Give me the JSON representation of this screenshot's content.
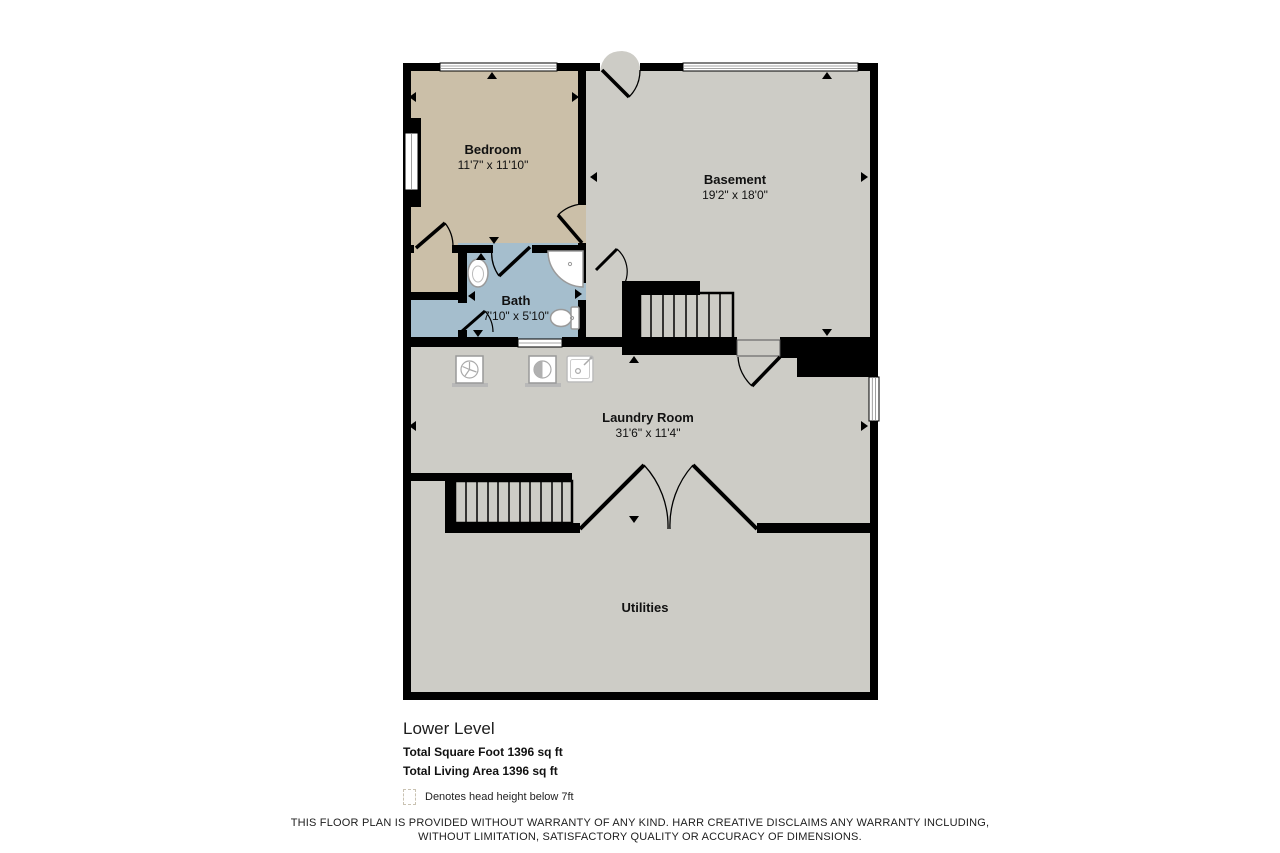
{
  "plan": {
    "rooms": {
      "bedroom": {
        "name": "Bedroom",
        "dims": "11'7\" x 11'10\""
      },
      "basement": {
        "name": "Basement",
        "dims": "19'2\" x 18'0\""
      },
      "bath": {
        "name": "Bath",
        "dims": "7'10\" x 5'10\""
      },
      "laundry": {
        "name": "Laundry Room",
        "dims": "31'6\" x 11'4\""
      },
      "utilities": {
        "name": "Utilities"
      }
    },
    "colors": {
      "bedroom_fill": "#cbbfa8",
      "bath_fill": "#a5becd",
      "common_fill": "#cdccc6",
      "wall": "#000000",
      "fixture_stroke": "#9a9a9a"
    },
    "fixtures": [
      "sink",
      "corner-shower",
      "toilet"
    ],
    "appliances": [
      "dryer",
      "washer",
      "laundry-sink"
    ]
  },
  "summary": {
    "level_label": "Lower Level",
    "total_square_foot": "Total Square Foot 1396 sq ft",
    "total_living_area": "Total Living Area 1396 sq ft",
    "legend_note": "Denotes head height below 7ft"
  },
  "footer": {
    "disclaimer_line1": "THIS FLOOR PLAN IS PROVIDED WITHOUT WARRANTY OF ANY KIND. HARR CREATIVE DISCLAIMS ANY WARRANTY INCLUDING,",
    "disclaimer_line2": "WITHOUT LIMITATION, SATISFACTORY QUALITY OR ACCURACY OF DIMENSIONS."
  }
}
